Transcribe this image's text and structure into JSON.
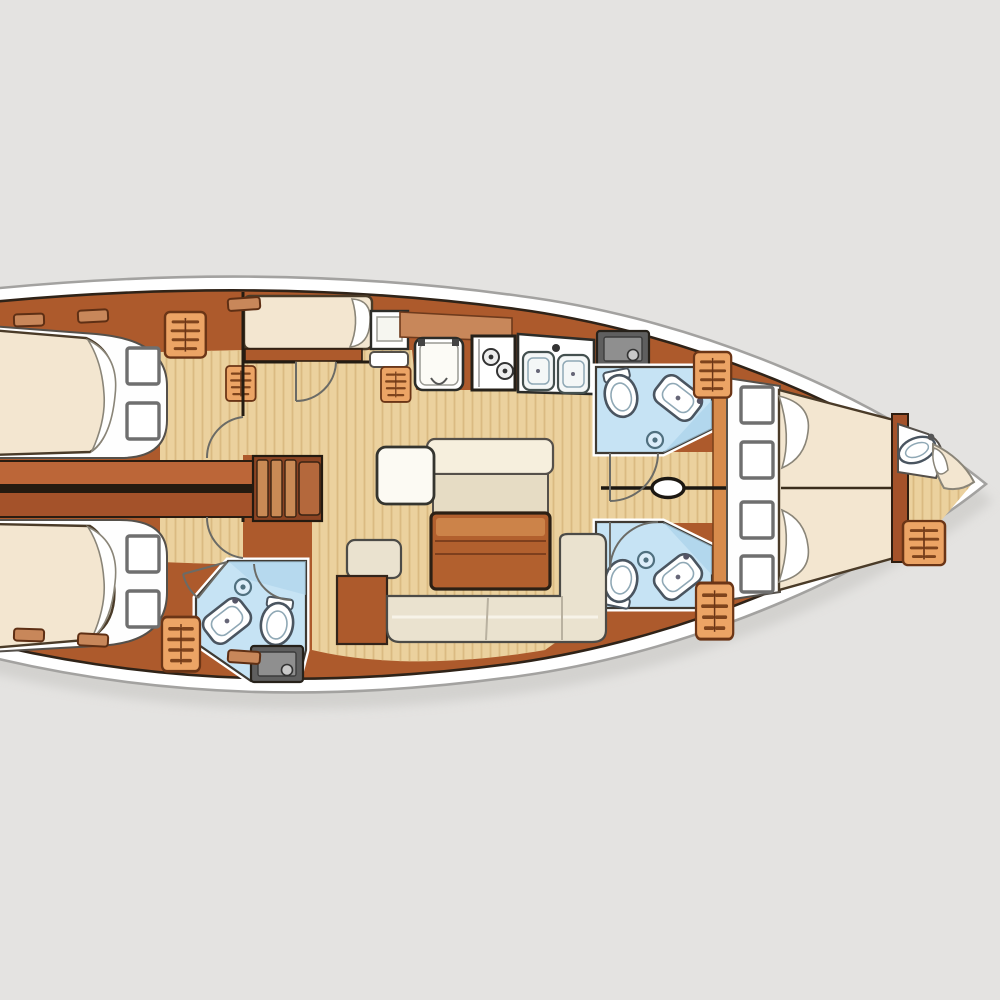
{
  "title": "sailing-yacht-interior-layout-floor-plan",
  "rooms": [
    "aft-cabin-port",
    "aft-cabin-starboard",
    "companionway-steps",
    "nav-cabin-with-berth-and-chart-table",
    "galley",
    "salon-with-table-and-u-settee",
    "head-aft",
    "head-forward-port",
    "head-forward-starboard",
    "corridor-with-mast",
    "forward-owners-cabin",
    "bow-vanity-and-chaise"
  ],
  "fixture_counts": {
    "beds": 4,
    "pillowed_berths": 4,
    "toilets": 3,
    "bathroom_sinks": 4,
    "shower_drains": 3,
    "deck_hatches": 2,
    "hull_windows": 8,
    "hanging_lockers": 7,
    "stove_burners": 2,
    "galley_sinks": 2,
    "fridge": 1,
    "chart_table": 1,
    "salon_table": 1,
    "mast": 1
  },
  "colors": {
    "bg": "#e4e3e1",
    "shadow": "#cfcecb",
    "hullWhite": "#ffffff",
    "hullEdge": "#a3a2a0",
    "wood": "#ad5a2c",
    "woodDark": "#a4522a",
    "woodLight": "#c8875a",
    "woodTrim": "#2f2318",
    "railTop": "#bc6638",
    "railBottom": "#a4522a",
    "stepBase": "#8c4423",
    "stepTread": "#c98a55",
    "floor": "#ebd19e",
    "floorStripe": "#d7b67c",
    "liner": "#fefefe",
    "linerEdge": "#55504a",
    "bed": "#f3e6d0",
    "bedEdge": "#4a3b28",
    "pillow": "#ffffff",
    "pillowEdge": "#8a8578",
    "windowEdge": "#6f6f6f",
    "bath": "#c6e3f4",
    "bathDeep": "#a9d2ea",
    "fixture": "#ffffff",
    "fixtureEdge": "#4a5560",
    "fixtureInner": "#8fa8b5",
    "wardrobe": "#eca465",
    "wardrobeEdge": "#6b3516",
    "wardrobeBar": "#7e431c",
    "hatchFrame": "#5f5f5f",
    "hatchGlass": "#8f8f8f",
    "hatchKnob": "#c9c9c9",
    "orangeWall": "#d88c4c",
    "benchBack": "#f6efdd",
    "benchSeat": "#e6dcc4",
    "settee": "#eae2cf",
    "setteeEdge": "#4c4b47",
    "sideTable": "#fcfaf3",
    "tableWood": "#b2602e",
    "tableEdge": "#2c2014",
    "tableLine": "#7e3f1d",
    "tableHighlight": "#d08a4e",
    "wall": "#241c12",
    "doorArc": "#6b6b66",
    "counter": "#ffffff",
    "counterEdge": "#2c2c28"
  }
}
